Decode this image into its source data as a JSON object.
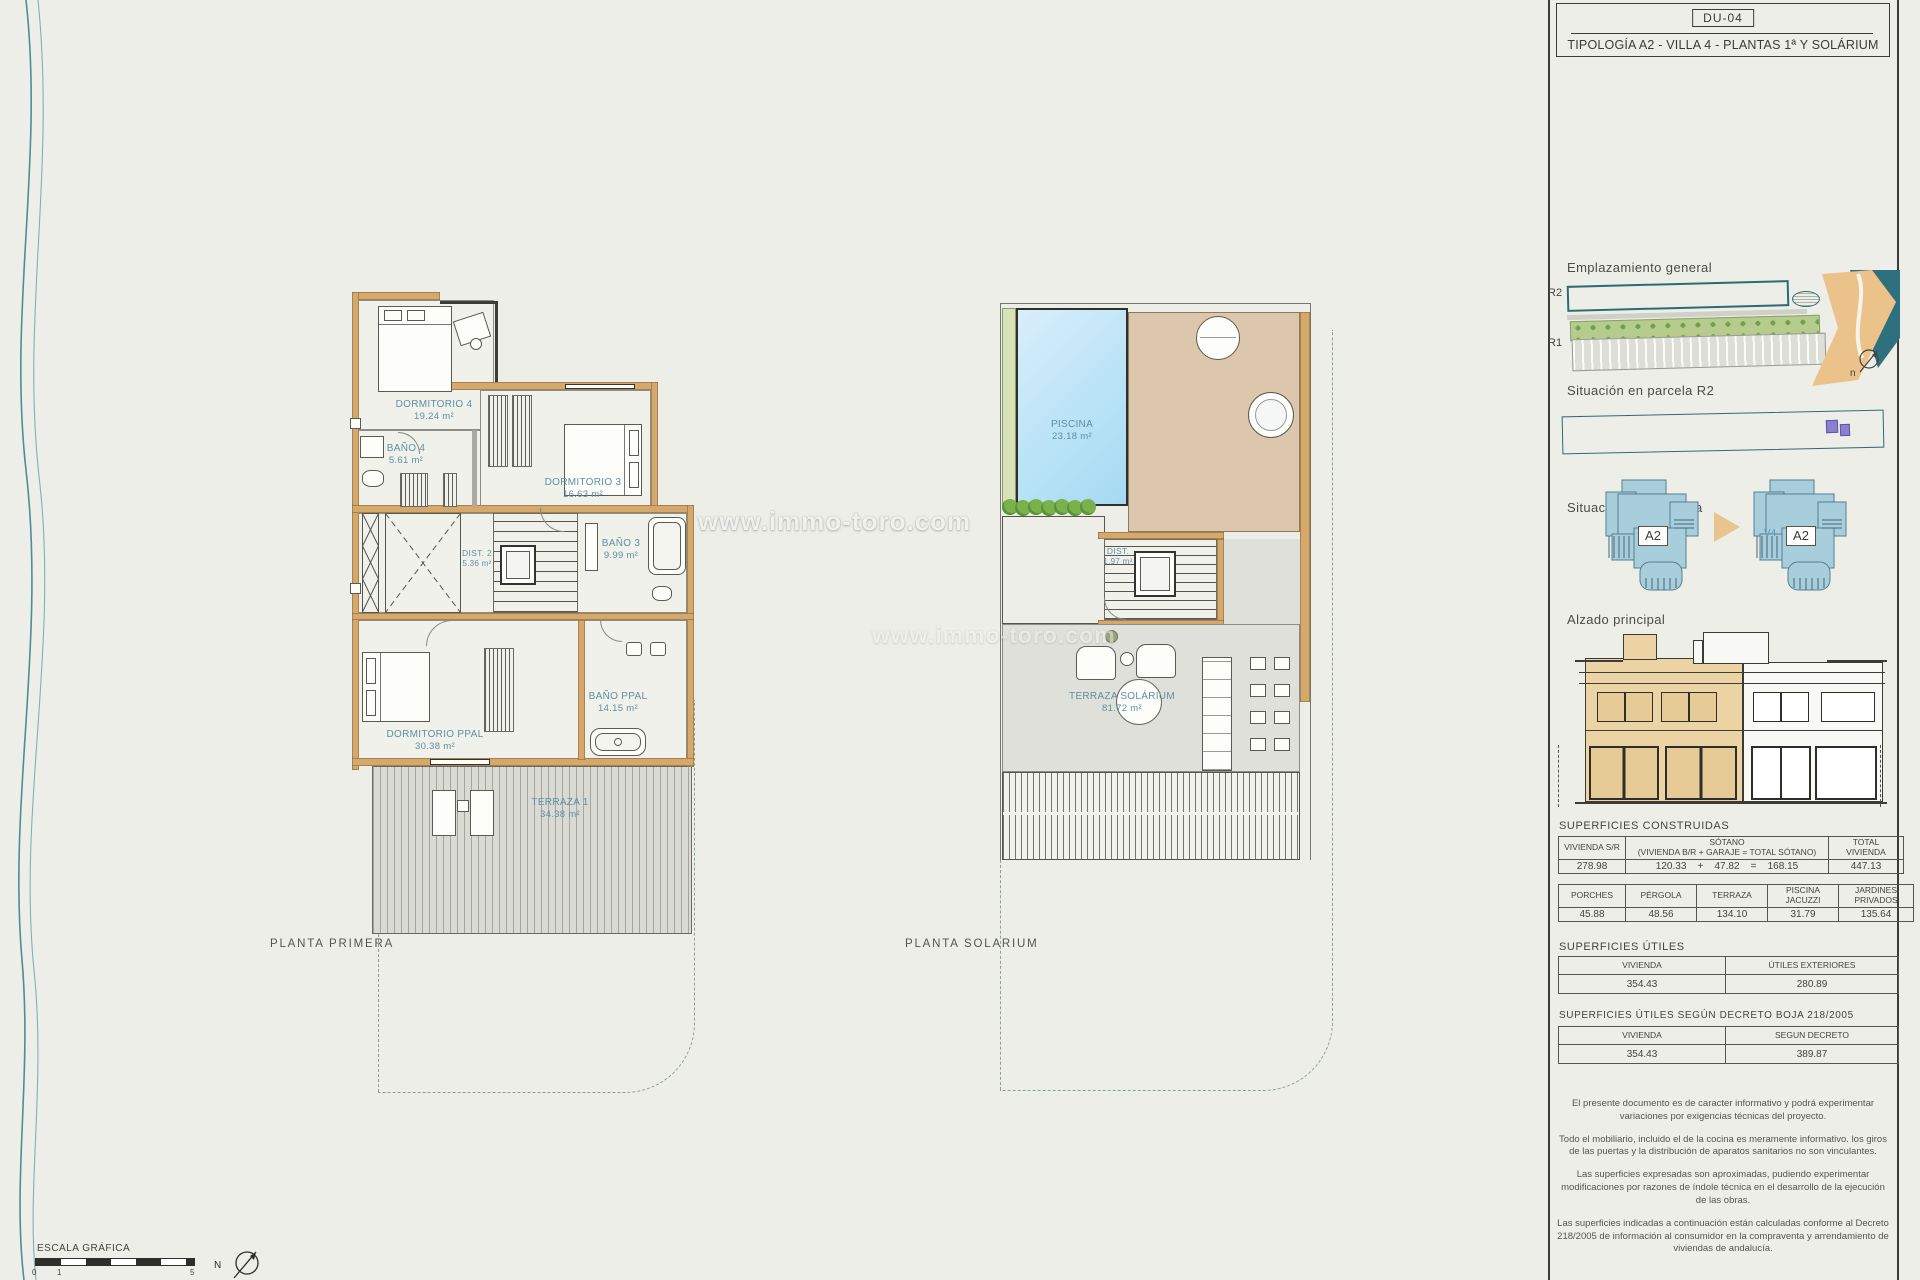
{
  "title_block": {
    "code": "DU-04",
    "title": "TIPOLOGÍA A2 - VILLA 4 - PLANTAS 1ª Y SOLÁRIUM"
  },
  "watermark": {
    "main": "www.immo-toro.com",
    "secondary": "www.immo-toro.com"
  },
  "plan_primera": {
    "title": "PLANTA PRIMERA",
    "rooms": {
      "dormitorio4": {
        "name": "DORMITORIO 4",
        "area": "19.24 m²"
      },
      "bano4": {
        "name": "BAÑO 4",
        "area": "5.61 m²"
      },
      "dormitorio3": {
        "name": "DORMITORIO 3",
        "area": "16.63 m²"
      },
      "bano3": {
        "name": "BAÑO 3",
        "area": "9.99 m²"
      },
      "dist2": {
        "name": "DIST. 2",
        "area": "5.36 m²"
      },
      "dormppal": {
        "name": "DORMITORIO PPAL",
        "area": "30.38 m²"
      },
      "banoppal": {
        "name": "BAÑO PPAL",
        "area": "14.15 m²"
      },
      "terraza1": {
        "name": "TERRAZA 1",
        "area": "34.38 m²"
      }
    }
  },
  "plan_solarium": {
    "title": "PLANTA SOLARIUM",
    "rooms": {
      "piscina": {
        "name": "PISCINA",
        "area": "23.18 m²"
      },
      "dist": {
        "name": "DIST.",
        "area": "1.97 m²"
      },
      "terraza": {
        "name": "TERRAZA SOLÁRIUM",
        "area": "81.72 m²"
      }
    }
  },
  "sidebar": {
    "emplazamiento_heading": "Emplazamiento general",
    "map": {
      "r2": "R2",
      "r1": "R1",
      "north": "n"
    },
    "parcela_heading": "Situación en parcela R2",
    "pareada_heading": "Situación por pareada",
    "pareada": {
      "left_label": "A2",
      "right_label": "A2",
      "right_tag": "V4"
    },
    "alzado_heading": "Alzado principal",
    "construidas": {
      "heading": "SUPERFICIES CONSTRUIDAS",
      "t1": {
        "c1": "VIVIENDA S/R",
        "c2a": "SÓTANO",
        "c2b": "(VIVIENDA B/R + GARAJE = TOTAL SÓTANO)",
        "c3a": "TOTAL",
        "c3b": "VIVIENDA",
        "v1": "278.98",
        "v2": [
          "120.33",
          "+",
          "47.82",
          "=",
          "168.15"
        ],
        "v3": "447.13"
      },
      "t2": {
        "h": [
          "PORCHES",
          "PÉRGOLA",
          "TERRAZA",
          "PISCINA",
          "JARDINES"
        ],
        "h2": [
          "",
          "",
          "",
          "JACUZZI",
          "PRIVADOS"
        ],
        "v": [
          "45.88",
          "48.56",
          "134.10",
          "31.79",
          "135.64"
        ]
      }
    },
    "utiles": {
      "heading": "SUPERFICIES ÚTILES",
      "h": [
        "VIVIENDA",
        "ÚTILES EXTERIORES"
      ],
      "v": [
        "354.43",
        "280.89"
      ]
    },
    "decreto": {
      "heading": "SUPERFICIES ÚTILES SEGÚN DECRETO BOJA 218/2005",
      "h": [
        "VIVIENDA",
        "SEGUN DECRETO"
      ],
      "v": [
        "354.43",
        "389.87"
      ]
    },
    "notes": [
      "El presente documento es de caracter informativo y podrá experimentar variaciones por exigencias técnicas del proyecto.",
      "Todo el mobiliario, incluido el de la cocina es meramente informativo. los giros de las puertas y la distribución de aparatos sanitarios no son vinculantes.",
      "Las superficies expresadas son aproximadas, pudiendo experimentar modificaciones por razones de índole técnica en el desarrollo de la ejecución de las obras.",
      "Las superficies indicadas a continuación están calculadas conforme al Decreto 218/2005 de información al consumidor en la compraventa y arrendamiento de viviendas de andalucía."
    ]
  },
  "footer": {
    "escala": "ESCALA GRÁFICA",
    "tick0": "0",
    "tick1": "1",
    "tick5": "5",
    "north": "N"
  }
}
